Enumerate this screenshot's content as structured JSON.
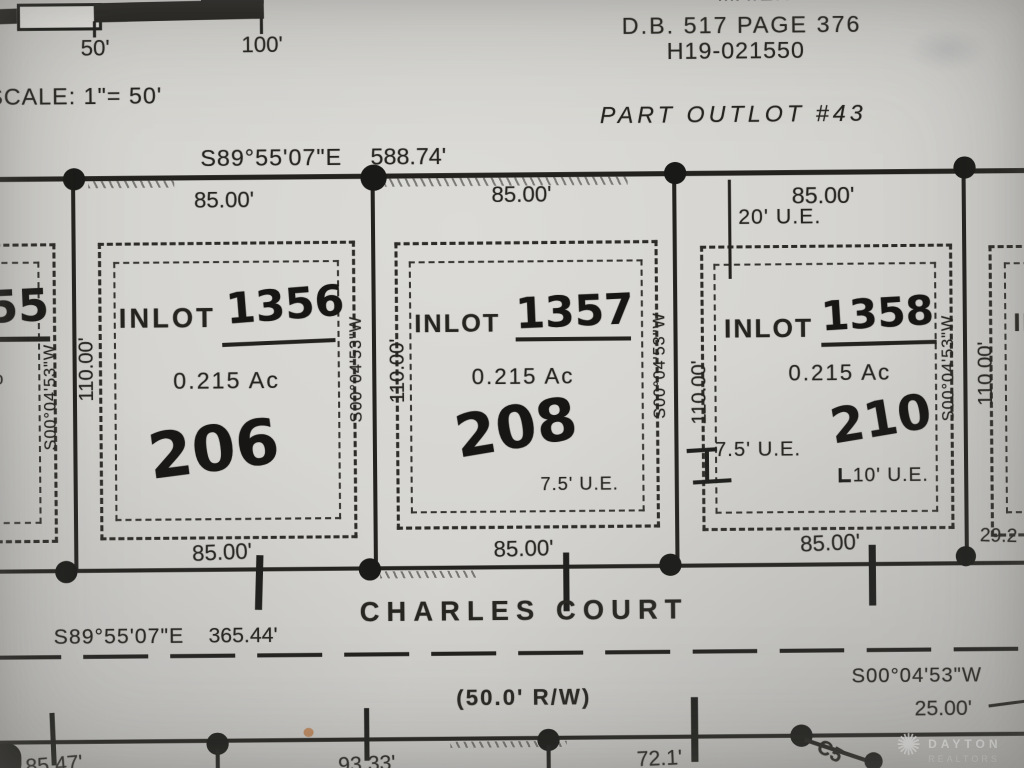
{
  "scale_bar": {
    "tick_50": "50'",
    "tick_100": "100'",
    "label": "SCALE: 1\"= 50'"
  },
  "title_block": {
    "name": "MAIER",
    "deed_book": "D.B. 517 PAGE 376",
    "parcel_number": "H19-021550",
    "outlot_label": "PART OUTLOT #43"
  },
  "north_boundary": {
    "bearing": "S89°55'07\"E",
    "distance": "588.74'"
  },
  "side_dimensions": {
    "bearing": "S00°04'53\"W",
    "depth": "110.00'"
  },
  "lots": [
    {
      "label": "INLOT",
      "number": "1356",
      "area": "0.215 Ac",
      "house_number": "206",
      "frontage_top": "85.00'",
      "frontage_bottom": "85.00'"
    },
    {
      "label": "INLOT",
      "number": "1357",
      "area": "0.215 Ac",
      "house_number": "208",
      "frontage_top": "85.00'",
      "frontage_bottom": "85.00'",
      "easement_right": "7.5' U.E."
    },
    {
      "label": "INLOT",
      "number": "1358",
      "area": "0.215 Ac",
      "house_number": "210",
      "frontage_top": "85.00'",
      "frontage_bottom": "85.00'",
      "easement_top": "20' U.E.",
      "easement_left": "7.5' U.E.",
      "easement_bottom": "10' U.E."
    }
  ],
  "partial_lot_left": {
    "number_fragment": "55",
    "area_fragment": "o"
  },
  "partial_lot_right": {
    "label_fragment": "IN",
    "dimension_fragment": "29.2"
  },
  "street": {
    "name": "CHARLES COURT",
    "bearing": "S89°55'07\"E",
    "distance": "365.44'",
    "right_of_way": "(50.0' R/W)"
  },
  "south_line": {
    "dim_1": "85.47'",
    "dim_2": "93.33'",
    "dim_3": "72.1'",
    "curve_label": "C5",
    "bearing": "S00°04'53\"W",
    "distance": "25.00'"
  },
  "watermark": {
    "icon": "sunburst-icon",
    "brand": "DAYTON",
    "brand_subtitle": "REALTORS"
  }
}
